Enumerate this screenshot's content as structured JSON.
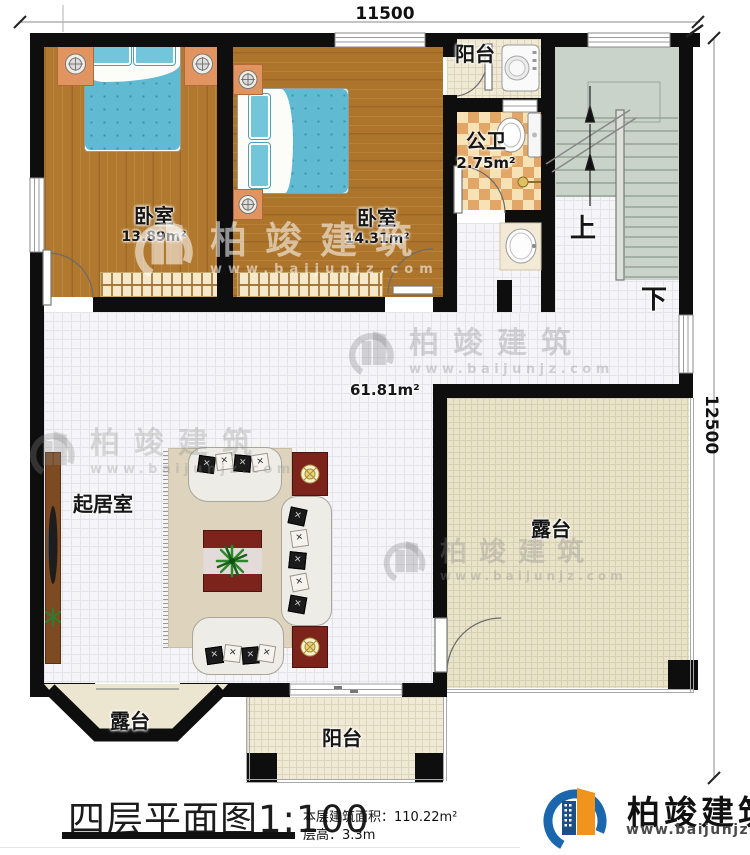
{
  "dimensions": {
    "top": "11500",
    "right": "12500"
  },
  "rooms": {
    "bedroom1": {
      "name": "卧室",
      "area": "13.89m²"
    },
    "bedroom2": {
      "name": "卧室",
      "area": "14.31m²"
    },
    "balcony_top": {
      "name": "阳台"
    },
    "bathroom": {
      "name": "公卫",
      "area": "2.75m²"
    },
    "living": {
      "name": "起居室",
      "area": "61.81m²"
    },
    "terrace_right": {
      "name": "露台"
    },
    "terrace_bay": {
      "name": "露台"
    },
    "balcony_bottom": {
      "name": "阳台"
    },
    "stairs": {
      "up": "上",
      "down": "下"
    }
  },
  "title": {
    "name": "四层平面图",
    "scale": "1:100"
  },
  "info": {
    "area_label": "本层建筑面积：",
    "area_value": "110.22m²",
    "height_label": "层高：",
    "height_value": "3.3m"
  },
  "brand": {
    "name": "柏竣建筑",
    "url": "www.baijunjz.com"
  },
  "watermark": {
    "name": "柏竣建筑",
    "url": "www.baijunjz.com"
  },
  "colors": {
    "wall": "#0e0e0e",
    "wood": "#b1792f",
    "bed": "#5fbad2",
    "brand_blue": "#1b67ad",
    "brand_orange": "#f0941d"
  }
}
